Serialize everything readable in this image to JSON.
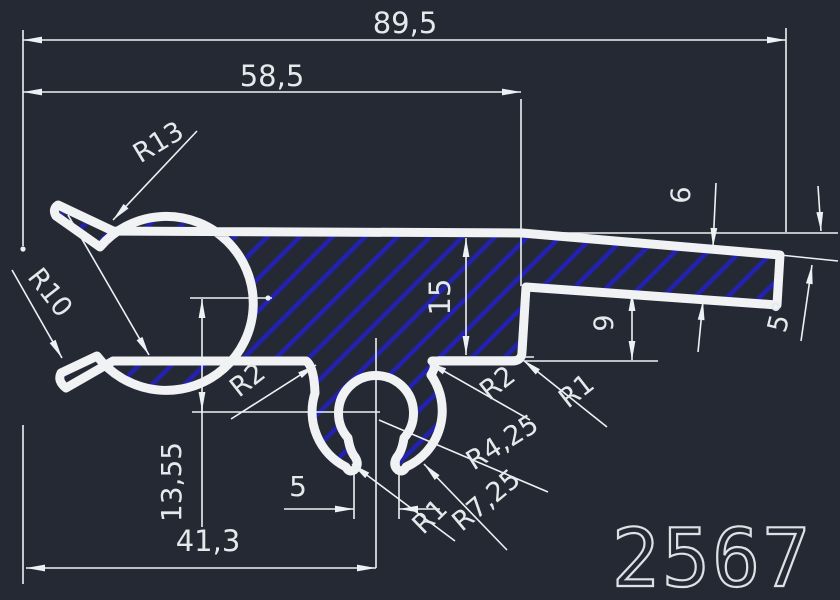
{
  "canvas": {
    "background": "#242933",
    "outline_color": "#f0f2f4",
    "hatch_color": "#2322b0",
    "dim_text_color": "#e6e9ec"
  },
  "part_label": "2567",
  "dimensions": {
    "overall_width": "89,5",
    "upper_width": "58,5",
    "body_height": "15",
    "arm_thickness": "6",
    "arm_offset": "9",
    "arm_angle": "5°",
    "clip_center_depth": "13,55",
    "clip_center_distance": "41,3",
    "clip_opening": "5"
  },
  "radii": {
    "lip_outer": "R13",
    "claw_inner": "R10",
    "left_root": "R2",
    "right_root": "R2",
    "step_corner": "R1",
    "clip_inner": "R4,25",
    "clip_outer": "R7,25",
    "hook_tip": "R1"
  }
}
